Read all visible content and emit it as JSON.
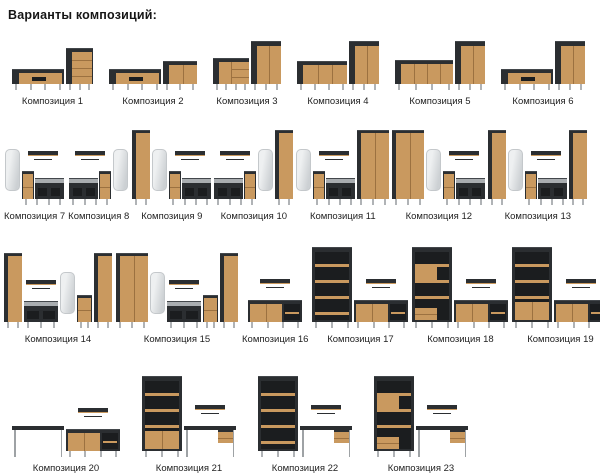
{
  "title": "Варианты композиций:",
  "colors": {
    "wood": "#c9995f",
    "body_dark": "#2b2e31",
    "interior_dark": "#1b1d1f",
    "mirror": "#dfe3e5",
    "cushion": "#a9adb0",
    "legs": "#b0b3b6",
    "background": "#ffffff"
  },
  "rows": [
    {
      "compositions": [
        {
          "label": "Композиция 1",
          "pieces": [
            "tvstand",
            "dresser"
          ]
        },
        {
          "label": "Композиция 2",
          "pieces": [
            "tvstand",
            "sideboard2"
          ]
        },
        {
          "label": "Композиция 3",
          "pieces": [
            "commode",
            "cabinet"
          ]
        },
        {
          "label": "Композиция 4",
          "pieces": [
            "sideboard3",
            "cabinet"
          ]
        },
        {
          "label": "Композиция 5",
          "pieces": [
            "sideboard4",
            "cabinet"
          ]
        },
        {
          "label": "Композиция 6",
          "pieces": [
            "tvstand",
            "cabinet"
          ]
        }
      ]
    },
    {
      "compositions": [
        {
          "label": "Композиция 7",
          "pieces": [
            "mirror",
            [
              "shelf",
              "hall-bench"
            ]
          ]
        },
        {
          "label": "Композиция 8",
          "pieces": [
            [
              "shelf",
              "hall-bench-r"
            ],
            "mirror"
          ]
        },
        {
          "label": "Композиция 9",
          "pieces": [
            "wardrobe-n",
            "mirror",
            [
              "shelf",
              "hall-bench"
            ]
          ]
        },
        {
          "label": "Композиция 10",
          "pieces": [
            [
              "shelf",
              "hall-bench-r"
            ],
            "mirror",
            "wardrobe-n"
          ]
        },
        {
          "label": "Композиция 11",
          "pieces": [
            "mirror",
            [
              "shelf",
              "hall-bench"
            ],
            "wardrobe-w"
          ]
        },
        {
          "label": "Композиция 12",
          "pieces": [
            "wardrobe-w",
            "mirror",
            [
              "shelf",
              "hall-bench"
            ]
          ]
        },
        {
          "label": "Композиция 13",
          "pieces": [
            "wardrobe-n",
            "mirror",
            [
              "shelf",
              "hall-bench"
            ],
            "wardrobe-n"
          ]
        }
      ]
    },
    {
      "compositions": [
        {
          "label": "Композиция 14",
          "pieces": [
            "wardrobe-n",
            [
              "shelf",
              "bench"
            ],
            "mirror",
            "drawers",
            "wardrobe-n"
          ]
        },
        {
          "label": "Композиция 15",
          "pieces": [
            "wardrobe-w",
            "mirror",
            [
              "shelf",
              "bench"
            ],
            "drawers",
            "wardrobe-n"
          ]
        },
        {
          "label": "Композиция 16",
          "pieces": [
            [
              "shelf",
              "sideboard-o"
            ]
          ]
        },
        {
          "label": "Композиция 17",
          "pieces": [
            "bookshelf",
            [
              "shelf",
              "sideboard-o"
            ]
          ]
        },
        {
          "label": "Композиция 18",
          "pieces": [
            "bookshelf-m",
            [
              "shelf",
              "sideboard-o"
            ]
          ]
        },
        {
          "label": "Композиция 19",
          "pieces": [
            "bookshelf-d",
            [
              "shelf",
              "sideboard-o"
            ]
          ]
        }
      ]
    },
    {
      "compositions": [
        {
          "label": "Композиция 20",
          "pieces": [
            "desk",
            [
              "shelf",
              "sideboard-o"
            ]
          ]
        },
        {
          "label": "Композиция 21",
          "pieces": [
            "bookshelf-d",
            [
              "shelf",
              "desk-d"
            ]
          ]
        },
        {
          "label": "Композиция 22",
          "pieces": [
            "bookshelf",
            [
              "shelf",
              "desk-d"
            ]
          ]
        },
        {
          "label": "Композиция 23",
          "pieces": [
            "bookshelf-m",
            [
              "shelf",
              "desk-d"
            ]
          ]
        }
      ]
    }
  ]
}
